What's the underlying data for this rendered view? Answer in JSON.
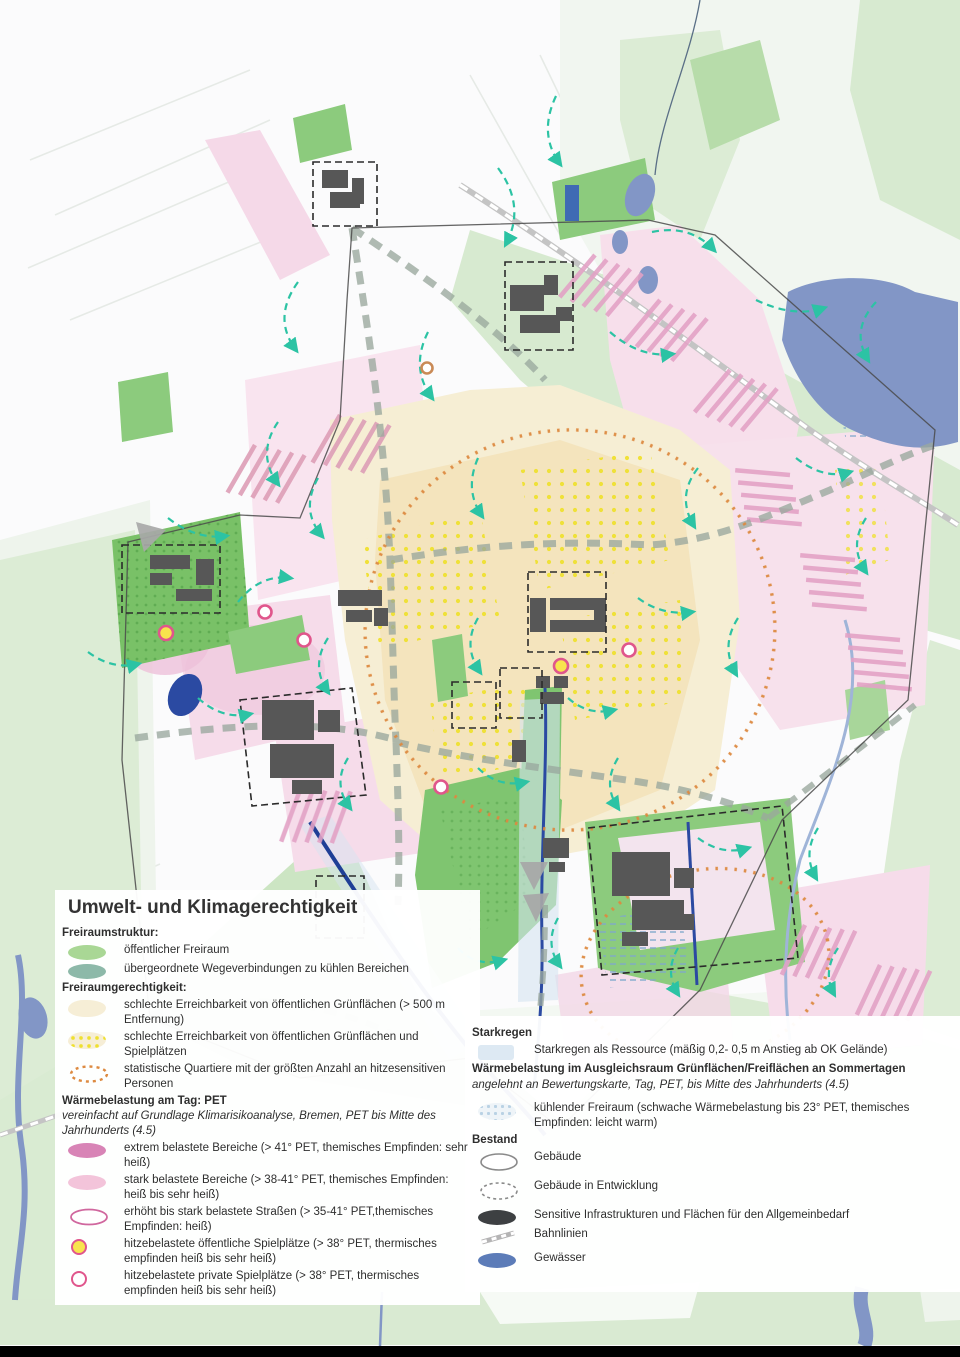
{
  "title": "Umwelt- und Klimagerechtigkeit",
  "legend_left": [
    {
      "kind": "header",
      "text": "Freiraumstruktur:"
    },
    {
      "kind": "item",
      "swatch": "public-open-space",
      "text": "öffentlicher Freiraum"
    },
    {
      "kind": "item",
      "swatch": "cool-connections",
      "text": "übergeordnete Wegeverbindungen zu kühlen Bereichen"
    },
    {
      "kind": "header",
      "text": "Freiraumgerechtigkeit:"
    },
    {
      "kind": "item",
      "swatch": "poor-access-green",
      "text": "schlechte Erreichbarkeit von öffentlichen Grünflächen (> 500 m Entfernung)"
    },
    {
      "kind": "item",
      "swatch": "poor-access-green-playgrounds",
      "text": "schlechte Erreichbarkeit von öffentlichen Grünflächen und Spielplätzen"
    },
    {
      "kind": "item",
      "swatch": "heat-sensitive-quarters",
      "text": "statistische Quartiere mit der größten Anzahl an hitzesensitiven Personen"
    },
    {
      "kind": "header",
      "text": "Wärmebelastung am Tag: PET"
    },
    {
      "kind": "note",
      "text": "vereinfacht auf Grundlage Klimarisikoanalyse, Bremen, PET bis Mitte des Jahrhunderts (4.5)"
    },
    {
      "kind": "item",
      "swatch": "extreme-heat-areas",
      "text": "extrem belastete Bereiche (> 41° PET, themisches Empfinden: sehr heiß)"
    },
    {
      "kind": "item",
      "swatch": "strong-heat-areas",
      "text": "stark belastete Bereiche (> 38-41° PET, themisches Empfinden: heiß bis sehr heiß)"
    },
    {
      "kind": "item",
      "swatch": "heat-streets",
      "text": "erhöht bis stark belastete Straßen (> 35-41° PET,themisches Empfinden: heiß)"
    },
    {
      "kind": "item",
      "swatch": "heat-public-playgrounds",
      "text": "hitzebelastete öffentliche Spielplätze (> 38° PET, thermisches empfinden heiß bis sehr heiß)"
    },
    {
      "kind": "item",
      "swatch": "heat-private-playgrounds",
      "text": "hitzebelastete private Spielplätze (> 38° PET, thermisches empfinden heiß bis sehr heiß)"
    }
  ],
  "legend_right": [
    {
      "kind": "header",
      "text": "Starkregen"
    },
    {
      "kind": "item",
      "swatch": "heavy-rain-resource",
      "text": "Starkregen als Ressource (mäßig 0,2- 0,5 m Anstieg ab OK Gelände)"
    },
    {
      "kind": "header",
      "text": "Wärmebelastung im Ausgleichsraum Grünflächen/Freiflächen an Sommertagen"
    },
    {
      "kind": "note",
      "text": "angelehnt an Bewertungskarte, Tag, PET, bis Mitte des Jahrhunderts (4.5)"
    },
    {
      "kind": "item",
      "swatch": "cooling-open-space",
      "text": "kühlender Freiraum (schwache Wärmebelastung bis 23° PET, themisches Empfinden: leicht warm)"
    },
    {
      "kind": "header",
      "text": "Bestand"
    },
    {
      "kind": "item",
      "swatch": "buildings",
      "text": "Gebäude"
    },
    {
      "kind": "item",
      "swatch": "buildings-in-development",
      "text": "Gebäude in Entwicklung"
    },
    {
      "kind": "item",
      "swatch": "sensitive-infrastructure",
      "text": "Sensitive Infrastrukturen und Flächen für den Allgemeinbedarf"
    },
    {
      "kind": "item",
      "swatch": "rail-lines",
      "text": "Bahnlinien"
    },
    {
      "kind": "item",
      "swatch": "water-bodies",
      "text": "Gewässer"
    }
  ],
  "colors": {
    "public_open_space_green": "#a9d795",
    "cool_connection_teal": "#8db9a9",
    "poor_access_cream": "#f6eed6",
    "playground_dot_yellow": "#efe030",
    "heat_sensitive_orange": "#dd8a41",
    "extreme_heat_pink": "#d884b6",
    "strong_heat_pink": "#f3c4da",
    "playground_ring_pink": "#e0568c",
    "cooling_blue": "#b9d2e4",
    "water_blue": "#5c7cb8",
    "building_gray": "#575757",
    "teal_arrow": "#2cc3a4",
    "road_gray": "#9aa89d"
  }
}
